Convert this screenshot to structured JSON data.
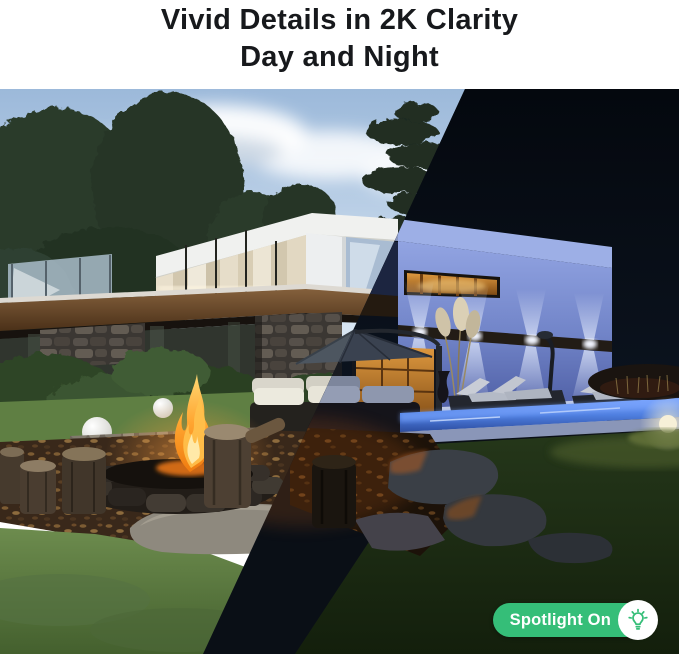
{
  "header": {
    "title_line1": "Vivid Details in 2K Clarity",
    "title_line2": "Day and Night"
  },
  "badge": {
    "label": "Spotlight On",
    "icon": "lightbulb-shine-icon",
    "bg_color": "#35BE78",
    "text_color": "#FFFFFF"
  },
  "scene": {
    "split": "diagonal-day-left-night-right",
    "colors": {
      "title_text": "#17191C",
      "day_sky": "#9CB9DA",
      "night_sky": "#070D15",
      "night_wall_blue": "#8095D6",
      "pool_glow": "#5E8EF2",
      "flame_orange": "#F08414",
      "grass_day": "#66854A",
      "grass_night": "#1C2A15",
      "wood_beam": "#7A5A38"
    }
  }
}
